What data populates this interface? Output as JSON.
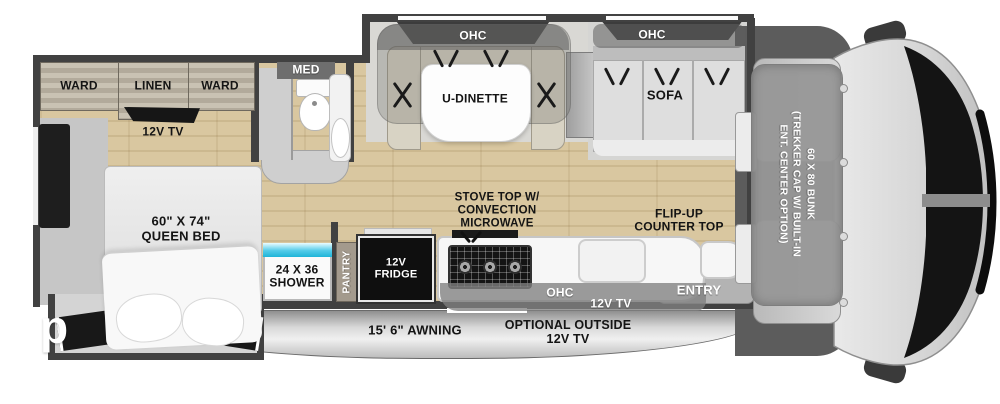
{
  "plan": {
    "bedroom": {
      "ward_left": "WARD",
      "linen": "LINEN",
      "ward_right": "WARD",
      "tv": "12V TV",
      "bed": "60\" X 74\"\nQUEEN BED"
    },
    "bath": {
      "med": "MED",
      "shower": "24 X 36\nSHOWER"
    },
    "kitchen": {
      "pantry": "PANTRY",
      "fridge": "12V\nFRIDGE",
      "stove": "STOVE TOP W/\nCONVECTION\nMICROWAVE",
      "ohc": "OHC",
      "tv": "12V TV",
      "flip_counter": "FLIP-UP\nCOUNTER TOP"
    },
    "dinette": {
      "ohc": "OHC",
      "label": "U-DINETTE"
    },
    "sofa": {
      "ohc": "OHC",
      "label": "SOFA"
    },
    "entry": "ENTRY",
    "bunk": "60 X 80 BUNK\n(TREKKER CAP W/ BUILT-IN\nENT. CENTER OPTION)",
    "exterior": {
      "awning": "15' 6\" AWNING",
      "outside_tv": "OPTIONAL OUTSIDE\n12V TV"
    },
    "watermark": "p"
  },
  "colors": {
    "wall": "#414141",
    "wood_floor": "#d9c7a0",
    "shower_glass": "#35c2e2",
    "awning_band": "#cfcfcf",
    "fridge": "#0f0f0f"
  }
}
